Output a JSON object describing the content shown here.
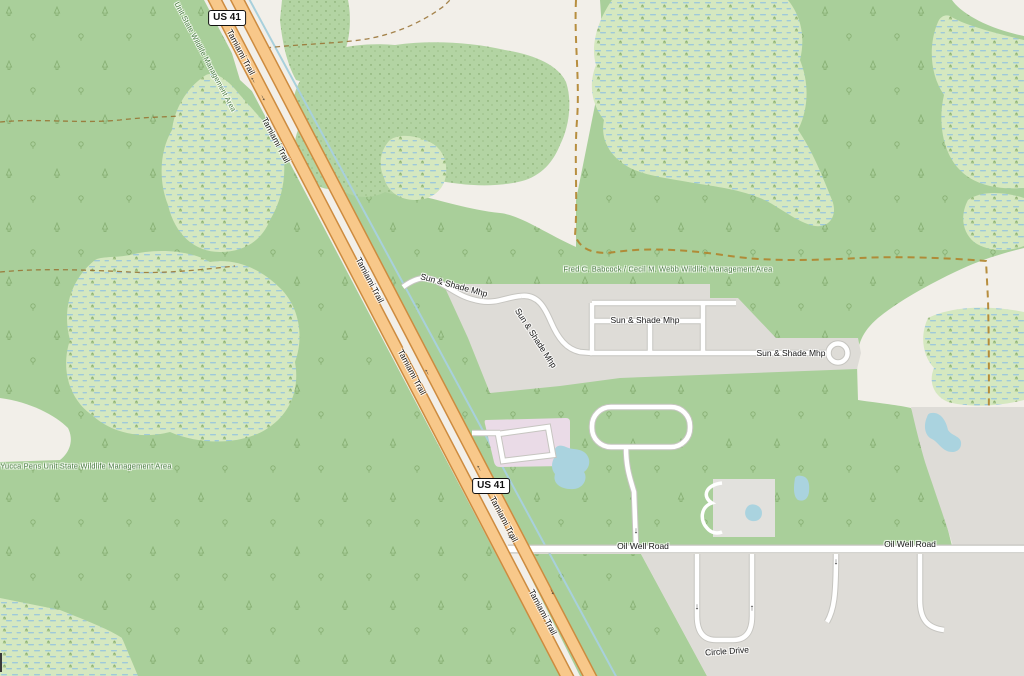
{
  "map": {
    "description": "OpenStreetMap standard-style map of the Tamiami Trail / Sun & Shade Mhp area",
    "colors": {
      "land_cream": "#f2efe9",
      "forest_green": "#a9cf9a",
      "scrub_green": "#b3d4a3",
      "wetland_green": "#d5e8c0",
      "wetland_dash_blue": "#9ec9da",
      "residential_gray": "#dedcd7",
      "retail_pink": "#eadbe7",
      "water_blue": "#aad3df",
      "trunk_fill": "#f8c88a",
      "trunk_casing": "#cd8b3f",
      "road_white": "#ffffff",
      "boundary_dash": "#b0832c",
      "area_label_green": "#47793f"
    },
    "shields": [
      {
        "label": "US 41",
        "x": 227,
        "y": 18
      },
      {
        "label": "US 41",
        "x": 491,
        "y": 486
      }
    ],
    "labels": [
      {
        "name": "road-label-tamiami-trail-1",
        "text": "Tamiami Trail",
        "x": 241,
        "y": 52,
        "rot": 62,
        "cls": ""
      },
      {
        "name": "road-label-tamiami-trail-2",
        "text": "Tamiami Trail",
        "x": 276,
        "y": 140,
        "rot": 62,
        "cls": ""
      },
      {
        "name": "road-label-tamiami-trail-3",
        "text": "Tamiami Trail",
        "x": 370,
        "y": 280,
        "rot": 62,
        "cls": ""
      },
      {
        "name": "road-label-tamiami-trail-4",
        "text": "Tamiami Trail",
        "x": 412,
        "y": 372,
        "rot": 62,
        "cls": ""
      },
      {
        "name": "road-label-tamiami-trail-5",
        "text": "Tamiami Trail",
        "x": 504,
        "y": 519,
        "rot": 62,
        "cls": ""
      },
      {
        "name": "road-label-tamiami-trail-6",
        "text": "Tamiami Trail",
        "x": 543,
        "y": 612,
        "rot": 62,
        "cls": ""
      },
      {
        "name": "road-label-sun-shade-mhp-1",
        "text": "Sun & Shade Mhp",
        "x": 454,
        "y": 285,
        "rot": 15,
        "cls": ""
      },
      {
        "name": "road-label-sun-shade-mhp-2",
        "text": "Sun & Shade Mhp",
        "x": 536,
        "y": 338,
        "rot": 57,
        "cls": ""
      },
      {
        "name": "road-label-sun-shade-mhp-3",
        "text": "Sun & Shade Mhp",
        "x": 645,
        "y": 320,
        "rot": 0,
        "cls": ""
      },
      {
        "name": "road-label-sun-shade-mhp-4",
        "text": "Sun & Shade Mhp",
        "x": 791,
        "y": 353,
        "rot": 0,
        "cls": ""
      },
      {
        "name": "road-label-oil-well-road-1",
        "text": "Oil Well Road",
        "x": 643,
        "y": 546,
        "rot": 0,
        "cls": ""
      },
      {
        "name": "road-label-oil-well-road-2",
        "text": "Oil Well Road",
        "x": 910,
        "y": 544,
        "rot": 0,
        "cls": ""
      },
      {
        "name": "road-label-circle-drive",
        "text": "Circle Drive",
        "x": 727,
        "y": 651,
        "rot": -4,
        "cls": ""
      },
      {
        "name": "area-label-babcock-webb-wma",
        "text": "Fred C. Babcock / Cecil M. Webb Wildlife Management Area",
        "x": 668,
        "y": 269,
        "rot": 0,
        "cls": "green"
      },
      {
        "name": "area-label-yucca-pens-wma",
        "text": "Yucca Pens Unit State Wildlife Management Area",
        "x": 86,
        "y": 466,
        "rot": 0,
        "cls": "green"
      },
      {
        "name": "area-label-yucca-pens-wma-rotated",
        "text": "Unit State Wildlife Management Area",
        "x": 205,
        "y": 57,
        "rot": 62,
        "cls": "green-rot"
      }
    ],
    "oneway_arrow_glyph": "↑",
    "oneway_arrows": [
      {
        "x": 253,
        "y": 80,
        "rot": -28
      },
      {
        "x": 263,
        "y": 98,
        "rot": 152
      },
      {
        "x": 427,
        "y": 372,
        "rot": -28
      },
      {
        "x": 479,
        "y": 468,
        "rot": -28
      },
      {
        "x": 509,
        "y": 536,
        "rot": 152
      },
      {
        "x": 552,
        "y": 592,
        "rot": 152
      },
      {
        "x": 697,
        "y": 607,
        "rot": 180
      },
      {
        "x": 752,
        "y": 608,
        "rot": 0
      },
      {
        "x": 836,
        "y": 562,
        "rot": 180
      },
      {
        "x": 636,
        "y": 531,
        "rot": 180
      }
    ]
  }
}
